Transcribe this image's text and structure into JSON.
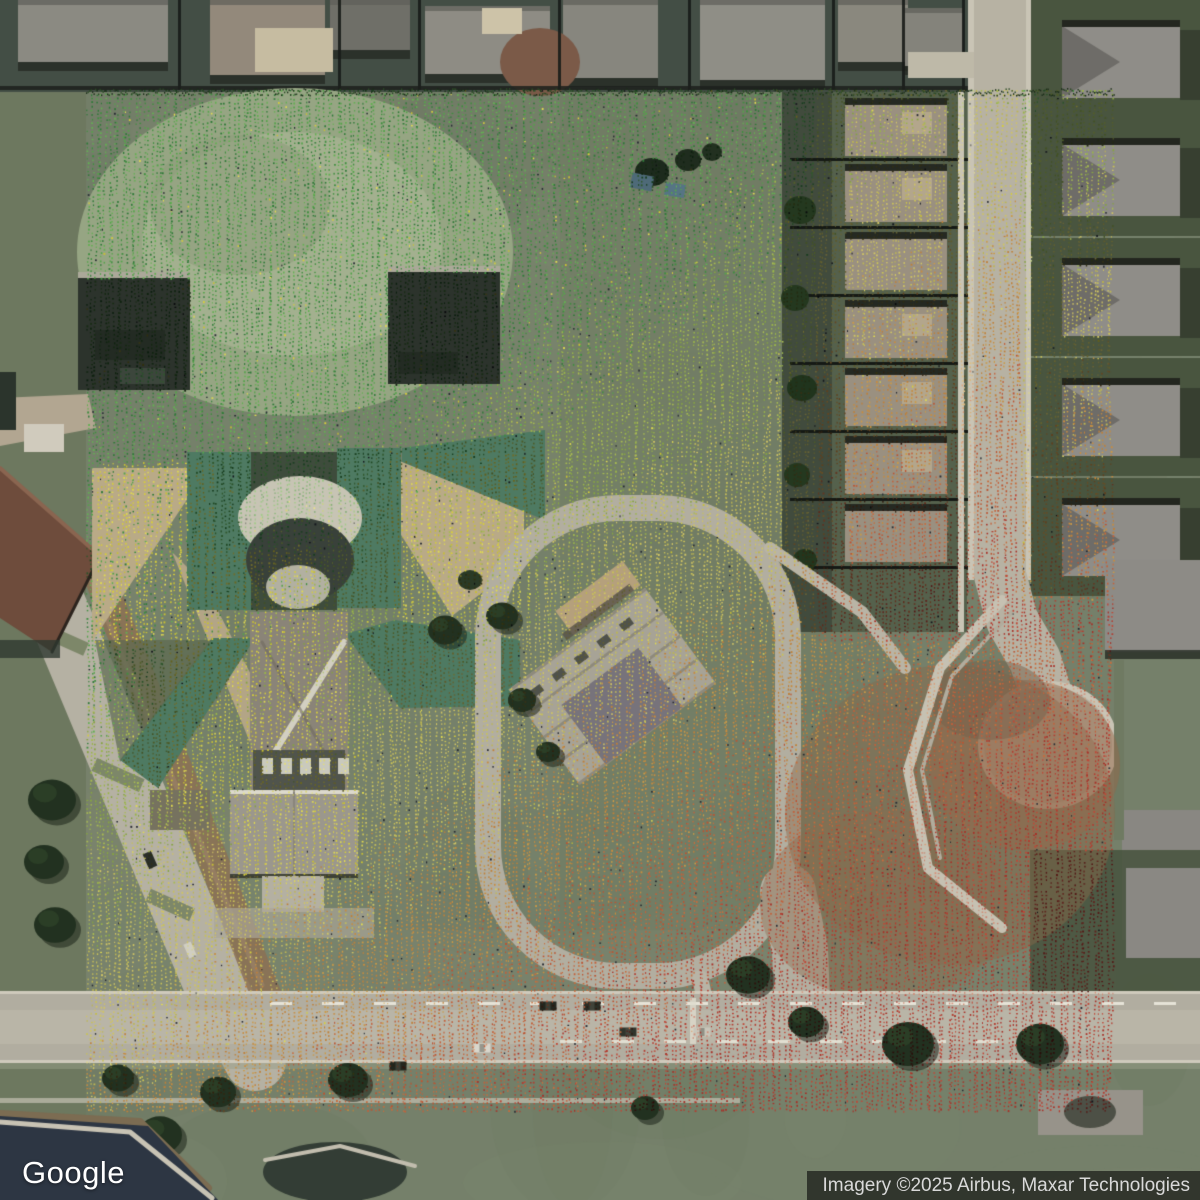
{
  "map": {
    "logo_text": "Google",
    "attribution": "Imagery ©2025 Airbus, Maxar Technologies"
  },
  "overlay": {
    "name": "lidar-elevation-point-cloud",
    "extent_px": {
      "left": 86,
      "top": 88,
      "right": 1114,
      "bottom": 1112
    },
    "palette": {
      "green_low": "#3f8f3f",
      "green_light": "#63b152",
      "yellow_green": "#9ab648",
      "khaki": "#c9c257",
      "yellow": "#d6ce3a",
      "orange": "#c88c3e",
      "orange_red": "#c4603a",
      "red": "#b43c30",
      "dark_red": "#7c241e"
    }
  }
}
